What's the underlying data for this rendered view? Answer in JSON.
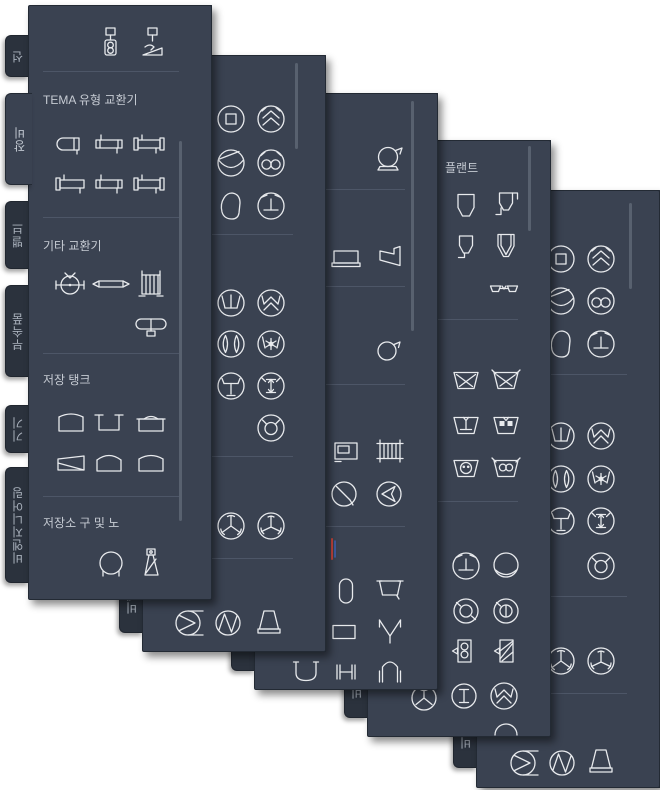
{
  "window": {
    "kind": "AutoCAD tool palettes",
    "background": "#ffffff"
  },
  "colors": {
    "panel": "#3a4251",
    "titlebar": "#303845",
    "tab": "#2b323d",
    "separator": "#4d5667",
    "header_text": "#c6cbd3",
    "icon_stroke": "#e8eaed",
    "scroll_thumb": "#58616f",
    "accent_red": "#c0443c",
    "accent_blue": "#3f63b8"
  },
  "controls": [
    "close",
    "auto-hide",
    "properties-menu",
    "palette-properties"
  ],
  "tabs": [
    {
      "label": "선",
      "top": 30,
      "h": 42
    },
    {
      "label": "장비",
      "top": 88,
      "h": 92,
      "selected": true
    },
    {
      "label": "밸브",
      "top": 196,
      "h": 68
    },
    {
      "label": "부속품",
      "top": 280,
      "h": 92
    },
    {
      "label": "기기",
      "top": 400,
      "h": 48
    },
    {
      "label": "비엔지니어링",
      "top": 462,
      "h": 116
    }
  ],
  "palettes": [
    {
      "id": "pip",
      "title": "도구 팔레트 - P&ID PIP",
      "left": 28,
      "top": 5,
      "h": 595,
      "headers": [
        {
          "text": "TEMA 유형 교환기",
          "x": 42,
          "y": 90
        },
        {
          "text": "기타 교환기",
          "x": 42,
          "y": 236
        },
        {
          "text": "저장 탱크",
          "x": 42,
          "y": 370
        },
        {
          "text": "저장소 구 및 노",
          "x": 42,
          "y": 513
        }
      ],
      "seps": [
        70,
        216,
        352,
        495
      ],
      "icons": [
        {
          "n": "inst1",
          "x": 110,
          "y": 42
        },
        {
          "n": "inst2",
          "x": 152,
          "y": 42
        },
        {
          "n": "hx_round",
          "x": 70,
          "y": 143
        },
        {
          "n": "hx_tube",
          "x": 108,
          "y": 143
        },
        {
          "n": "hx_tube2",
          "x": 148,
          "y": 143
        },
        {
          "n": "hx_tube3",
          "x": 70,
          "y": 183
        },
        {
          "n": "hx_tube",
          "x": 108,
          "y": 183
        },
        {
          "n": "hx_tube2",
          "x": 148,
          "y": 183
        },
        {
          "n": "kettle",
          "x": 70,
          "y": 283
        },
        {
          "n": "plate",
          "x": 110,
          "y": 283
        },
        {
          "n": "hairpin",
          "x": 150,
          "y": 283
        },
        {
          "n": "aircool",
          "x": 150,
          "y": 322
        },
        {
          "n": "tank_arc",
          "x": 70,
          "y": 422
        },
        {
          "n": "tank_u",
          "x": 108,
          "y": 422
        },
        {
          "n": "tank_lid",
          "x": 150,
          "y": 422
        },
        {
          "n": "tank_slope",
          "x": 70,
          "y": 462
        },
        {
          "n": "tank_dome",
          "x": 108,
          "y": 462
        },
        {
          "n": "tank_dome2",
          "x": 150,
          "y": 462
        },
        {
          "n": "sphere",
          "x": 110,
          "y": 563
        },
        {
          "n": "bottle",
          "x": 150,
          "y": 563
        }
      ],
      "scroll": {
        "x": 150,
        "y1": 140,
        "y2": 520
      }
    },
    {
      "id": "iso",
      "title": "도구 팔레트 - P&ID ISO",
      "left": 142,
      "top": 55,
      "h": 597,
      "headers": [],
      "seps": [
        233,
        455,
        557
      ],
      "icons": [
        {
          "n": "c_square",
          "x": 230,
          "y": 118
        },
        {
          "n": "c_dblchev",
          "x": 270,
          "y": 118
        },
        {
          "n": "c_curve",
          "x": 230,
          "y": 162
        },
        {
          "n": "c_inf",
          "x": 270,
          "y": 162
        },
        {
          "n": "blob",
          "x": 230,
          "y": 205
        },
        {
          "n": "c_T",
          "x": 270,
          "y": 205
        },
        {
          "n": "c_T2",
          "x": 230,
          "y": 302
        },
        {
          "n": "c_chev",
          "x": 270,
          "y": 302
        },
        {
          "n": "c_leaves",
          "x": 230,
          "y": 343
        },
        {
          "n": "c_star",
          "x": 270,
          "y": 343
        },
        {
          "n": "c_Tinv",
          "x": 230,
          "y": 385
        },
        {
          "n": "c_Iarrow",
          "x": 270,
          "y": 385
        },
        {
          "n": "c_circ",
          "x": 270,
          "y": 427
        },
        {
          "n": "c_3blade",
          "x": 230,
          "y": 525
        },
        {
          "n": "c_3blade2",
          "x": 270,
          "y": 525
        },
        {
          "n": "c_sigma",
          "x": 188,
          "y": 622
        },
        {
          "n": "c_wave",
          "x": 227,
          "y": 622
        },
        {
          "n": "trap",
          "x": 268,
          "y": 621
        }
      ],
      "scroll": {
        "x": 152,
        "y1": 62,
        "y2": 148
      }
    },
    {
      "id": "isa",
      "title": "도구 팔레트 - P&ID ISA",
      "left": 254,
      "top": 93,
      "h": 597,
      "headers": [],
      "seps": [
        188,
        285,
        383,
        525
      ],
      "icons": [
        {
          "n": "blower",
          "x": 388,
          "y": 158
        },
        {
          "n": "rect_screen",
          "x": 345,
          "y": 257
        },
        {
          "n": "cone_side",
          "x": 389,
          "y": 255
        },
        {
          "n": "blower2",
          "x": 387,
          "y": 350
        },
        {
          "n": "rect_inner",
          "x": 345,
          "y": 450
        },
        {
          "n": "comb",
          "x": 389,
          "y": 450
        },
        {
          "n": "c_diag",
          "x": 343,
          "y": 493
        },
        {
          "n": "c_poly",
          "x": 388,
          "y": 493
        },
        {
          "n": "red_frag",
          "x": 332,
          "y": 548
        },
        {
          "n": "vrect",
          "x": 345,
          "y": 590
        },
        {
          "n": "bucket",
          "x": 389,
          "y": 588
        },
        {
          "n": "rect2",
          "x": 343,
          "y": 631
        },
        {
          "n": "funnelV",
          "x": 389,
          "y": 629
        },
        {
          "n": "bowl",
          "x": 305,
          "y": 670
        },
        {
          "n": "hbeam",
          "x": 345,
          "y": 671
        },
        {
          "n": "arch",
          "x": 389,
          "y": 669
        }
      ],
      "scroll": {
        "x": 156,
        "y1": 100,
        "y2": 330
      }
    },
    {
      "id": "din",
      "title": "도구 팔레트 - P&ID DIN",
      "left": 367,
      "top": 140,
      "h": 597,
      "headers": [
        {
          "text": "플랜트",
          "x": 444,
          "y": 158
        }
      ],
      "seps": [
        318,
        500
      ],
      "icons": [
        {
          "n": "hopper",
          "x": 465,
          "y": 205
        },
        {
          "n": "hopper_legs",
          "x": 505,
          "y": 203
        },
        {
          "n": "hopper_leg",
          "x": 465,
          "y": 245
        },
        {
          "n": "hopper_dbl",
          "x": 505,
          "y": 245
        },
        {
          "n": "glasses",
          "x": 503,
          "y": 288
        },
        {
          "n": "trapX",
          "x": 465,
          "y": 380
        },
        {
          "n": "trapX2",
          "x": 505,
          "y": 380
        },
        {
          "n": "trapT",
          "x": 465,
          "y": 425
        },
        {
          "n": "trap_dots",
          "x": 505,
          "y": 425
        },
        {
          "n": "trap_face",
          "x": 465,
          "y": 468
        },
        {
          "n": "trap_inf",
          "x": 505,
          "y": 468
        },
        {
          "n": "c_T",
          "x": 465,
          "y": 565
        },
        {
          "n": "c_curveB",
          "x": 505,
          "y": 565
        },
        {
          "n": "c_O",
          "x": 465,
          "y": 610
        },
        {
          "n": "c_O2",
          "x": 505,
          "y": 610
        },
        {
          "n": "rect8",
          "x": 463,
          "y": 650
        },
        {
          "n": "rect_hatch",
          "x": 505,
          "y": 650
        },
        {
          "n": "c_Y",
          "x": 423,
          "y": 697
        },
        {
          "n": "c_I",
          "x": 463,
          "y": 695
        },
        {
          "n": "c_chev",
          "x": 503,
          "y": 695
        },
        {
          "n": "arc_top",
          "x": 505,
          "y": 732
        }
      ],
      "scroll": {
        "x": 160,
        "y1": 145,
        "y2": 230
      }
    },
    {
      "id": "jis-iso",
      "title": "도구 팔레트 - P&ID JIS-ISO",
      "left": 476,
      "top": 190,
      "h": 598,
      "headers": [],
      "seps": [
        373,
        595,
        692
      ],
      "icons": [
        {
          "n": "c_square",
          "x": 560,
          "y": 258
        },
        {
          "n": "c_dblchev",
          "x": 600,
          "y": 258
        },
        {
          "n": "c_curve",
          "x": 560,
          "y": 300
        },
        {
          "n": "c_inf",
          "x": 600,
          "y": 300
        },
        {
          "n": "blob",
          "x": 560,
          "y": 343
        },
        {
          "n": "c_T",
          "x": 600,
          "y": 343
        },
        {
          "n": "c_T2",
          "x": 560,
          "y": 435
        },
        {
          "n": "c_chev",
          "x": 600,
          "y": 435
        },
        {
          "n": "c_leaves",
          "x": 560,
          "y": 478
        },
        {
          "n": "c_star",
          "x": 600,
          "y": 478
        },
        {
          "n": "c_Tinv",
          "x": 560,
          "y": 520
        },
        {
          "n": "c_Iarrow",
          "x": 600,
          "y": 520
        },
        {
          "n": "c_circ",
          "x": 600,
          "y": 565
        },
        {
          "n": "c_3blade",
          "x": 560,
          "y": 660
        },
        {
          "n": "c_3blade2",
          "x": 600,
          "y": 660
        },
        {
          "n": "c_sigma",
          "x": 523,
          "y": 762
        },
        {
          "n": "c_wave",
          "x": 561,
          "y": 762
        },
        {
          "n": "trap",
          "x": 600,
          "y": 760
        }
      ],
      "scroll": {
        "x": 152,
        "y1": 202,
        "y2": 288
      }
    }
  ]
}
